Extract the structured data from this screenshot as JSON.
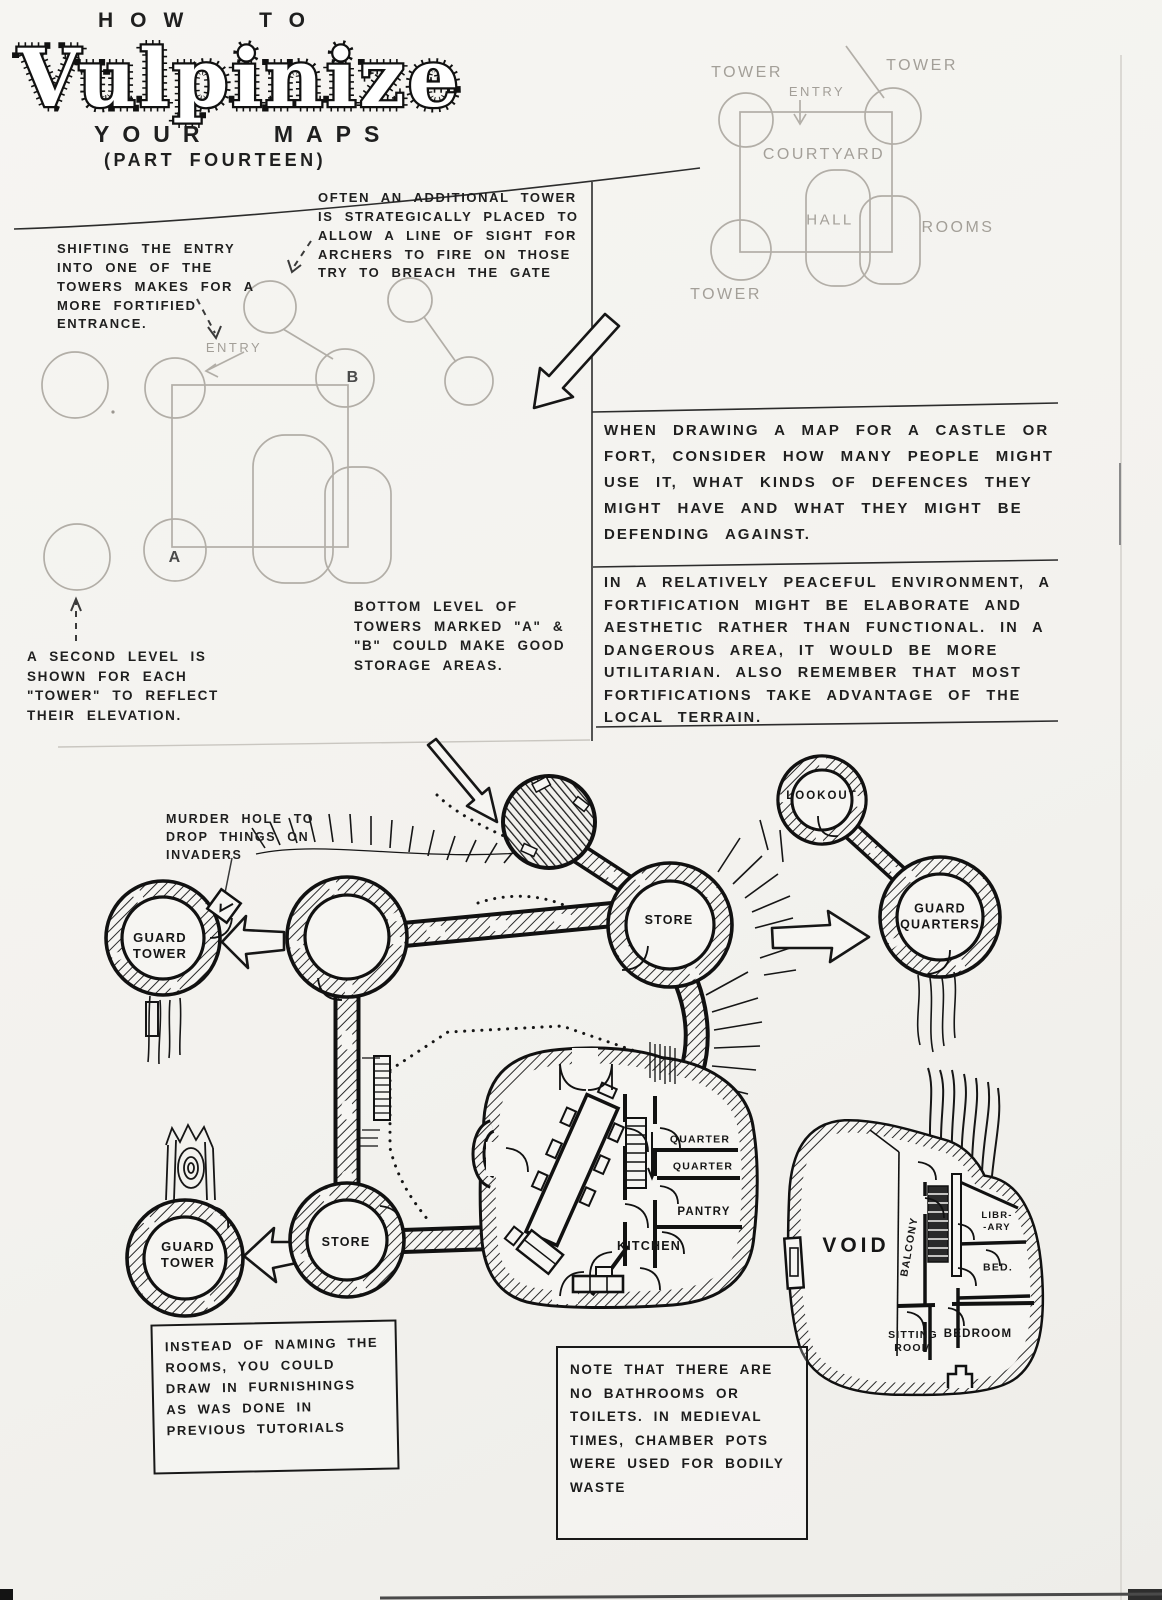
{
  "colors": {
    "paper": "#f4f3f0",
    "ink": "#1b1b1b",
    "pencil": "#b2aea7"
  },
  "title": {
    "pre": "HOW TO",
    "main": "Vulpinize",
    "sub": "YOUR MAPS",
    "part": "(PART FOURTEEN)"
  },
  "notes": {
    "shifting_entry": "SHIFTING THE ENTRY INTO ONE OF THE TOWERS MAKES FOR A MORE FORTIFIED ENTRANCE.",
    "additional_tower": "OFTEN AN ADDITIONAL TOWER IS STRATEGICALLY PLACED TO ALLOW A LINE OF SIGHT FOR ARCHERS TO FIRE ON THOSE TRY TO BREACH THE GATE",
    "second_level": "A SECOND LEVEL IS SHOWN FOR EACH \"TOWER\" TO REFLECT THEIR ELEVATION.",
    "bottom_level": "BOTTOM LEVEL OF TOWERS MARKED \"A\" & \"B\" COULD MAKE GOOD STORAGE AREAS.",
    "murder_hole": "MURDER HOLE TO DROP THINGS ON INVADERS",
    "when_drawing": "WHEN DRAWING A MAP FOR A CASTLE OR FORT, CONSIDER HOW MANY PEOPLE MIGHT USE IT, WHAT KINDS OF DEFENCES THEY MIGHT HAVE AND WHAT THEY MIGHT BE DEFENDING AGAINST.",
    "peaceful": "IN A RELATIVELY PEACEFUL ENVIRONMENT, A FORTIFICATION MIGHT BE ELABORATE AND AESTHETIC RATHER THAN FUNCTIONAL. IN A DANGEROUS AREA, IT WOULD BE MORE UTILITARIAN. ALSO REMEMBER THAT MOST FORTIFICATIONS TAKE ADVANTAGE OF THE LOCAL TERRAIN.",
    "instead_of_naming": "INSTEAD OF NAMING THE ROOMS, YOU COULD DRAW IN FURNISHINGS AS WAS DONE IN PREVIOUS TUTORIALS",
    "no_bathrooms": "NOTE THAT THERE ARE NO BATHROOMS OR TOILETS. IN MEDIEVAL TIMES, CHAMBER POTS WERE USED FOR BODILY WASTE"
  },
  "sketch_top_right": {
    "tower_top_left": "TOWER",
    "tower_top_right": "TOWER",
    "tower_bottom": "TOWER",
    "entry": "ENTRY",
    "courtyard": "COURTYARD",
    "hall": "HALL",
    "rooms": "ROOMS"
  },
  "sketch_mid_left": {
    "entry": "ENTRY",
    "tower_a": "A",
    "tower_b": "B"
  },
  "fort_map": {
    "guard_tower_nw": "GUARD\nTOWER",
    "guard_tower_sw": "GUARD\nTOWER",
    "store_ne": "STORE",
    "store_sw": "STORE",
    "lookout": "LOOKOUT",
    "guard_quarters": "GUARD\nQUARTERS",
    "quarter_1": "QUARTER",
    "quarter_2": "QUARTER",
    "pantry": "PANTRY",
    "kitchen": "KITCHEN"
  },
  "tower_house_map": {
    "void": "VOID",
    "balcony": "BALCONY",
    "library": "LIBR-\n-ARY",
    "bed": "BED.",
    "sitting_room": "SITTING\nROOM",
    "bedroom": "BEDROOM"
  }
}
